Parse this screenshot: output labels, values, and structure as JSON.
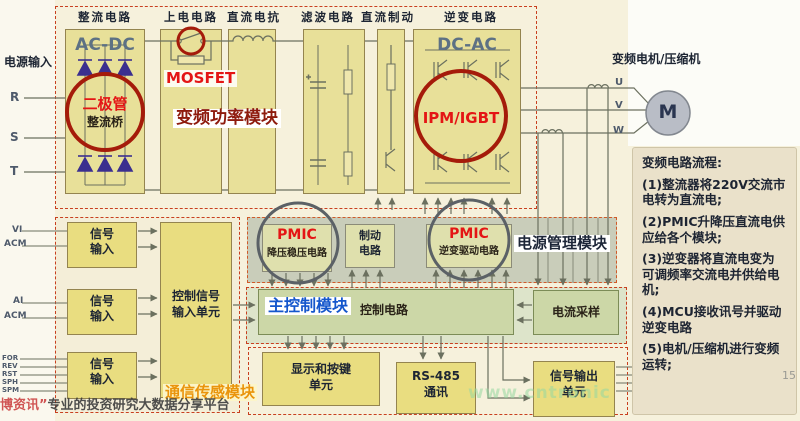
{
  "top_module": {
    "title": "变频功率模块",
    "columns": [
      "整流电路",
      "上电电路",
      "直流电抗",
      "滤波电路",
      "直流制动",
      "逆变电路"
    ],
    "acdc_label": "AC-DC",
    "dcac_label": "DC-AC",
    "diode_callout_line1": "二极管",
    "diode_callout_line2": "整流桥",
    "mosfet_label": "MOSFET",
    "ipm_label": "IPM/IGBT"
  },
  "power_input": {
    "label": "电源输入",
    "phases": [
      "R",
      "S",
      "T"
    ]
  },
  "motor": {
    "label": "变频电机/压缩机",
    "symbol": "M",
    "phases": [
      "U",
      "V",
      "W"
    ]
  },
  "power_mgmt": {
    "title": "电源管理模块",
    "pmic_buck_chip": "PMIC",
    "pmic_buck_desc": "降压稳压电路",
    "brake_line1": "制动",
    "brake_line2": "电路",
    "pmic_drive_chip": "PMIC",
    "pmic_drive_desc": "逆变驱动电路"
  },
  "main_control": {
    "title": "主控制模块",
    "circuit_label": "控制电路",
    "current_sampling": "电流采样"
  },
  "io_units": {
    "display_line1": "显示和按键",
    "display_line2": "单元",
    "rs485_line1": "RS-485",
    "rs485_line2": "通讯",
    "sigout_line1": "信号输出",
    "sigout_line2": "单元"
  },
  "comm_module": {
    "title": "通信传感模块",
    "input_line1": "信号",
    "input_line2": "输入",
    "ctrl_input_line1": "控制信号",
    "ctrl_input_line2": "输入单元",
    "terminals_a": [
      "VI",
      "ACM"
    ],
    "terminals_b": [
      "AI",
      "ACM"
    ],
    "terminals_c": [
      "FOR",
      "REV",
      "RST",
      "SPH",
      "SPM"
    ]
  },
  "flow_panel": {
    "title": "变频电路流程:",
    "steps": [
      "(1)整流器将220V交流市电转为直流电;",
      "(2)PMIC升降压直流电供应给各个模块;",
      "(3)逆变器将直流电变为可调频率交流电并供给电机;",
      "(4)MCU接收讯号并驱动逆变电路",
      "(5)电机/压缩机进行变频运转;"
    ]
  },
  "watermarks": {
    "site_red": "博资讯”",
    "site_text": "专业的投资研究大数据分享平台",
    "green": "www.cntronic",
    "corner": "15"
  },
  "colors": {
    "callout_red": "#a51b0a",
    "hot_red": "#e41515",
    "dark_red": "#8e1b0d",
    "navy": "#1d2533",
    "control_blue": "#1456cc",
    "comm_orange": "#ea940b"
  }
}
